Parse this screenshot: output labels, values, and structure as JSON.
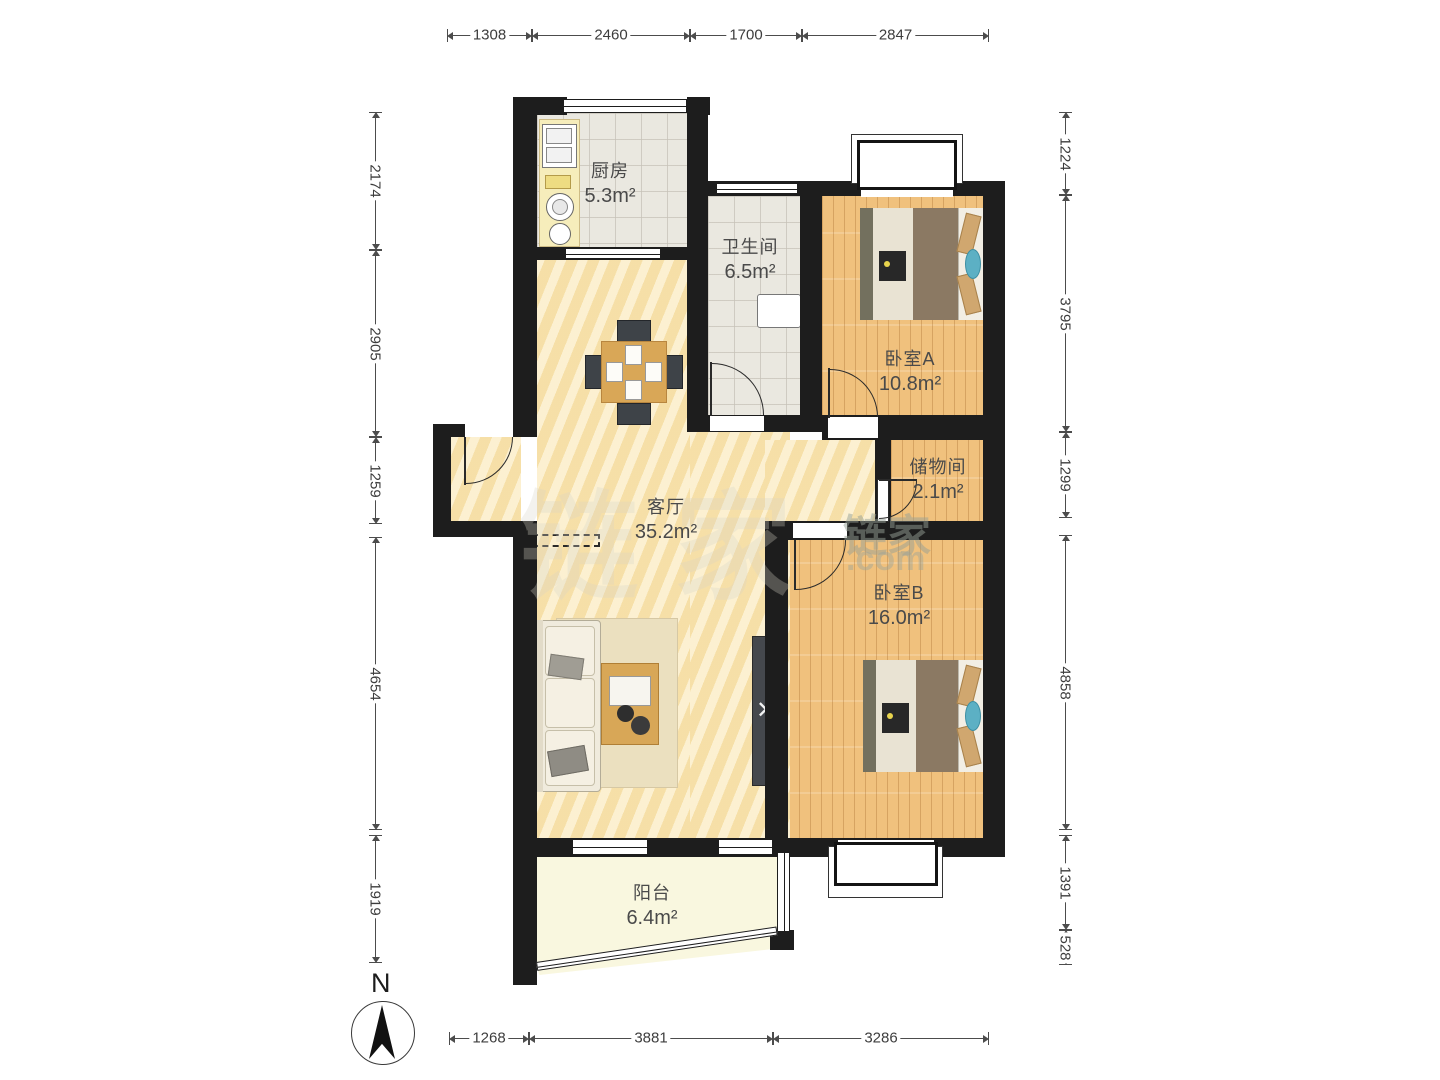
{
  "meta": {
    "type": "residential-floor-plan",
    "orientation_label": "N"
  },
  "north_indicator": {
    "label": "N"
  },
  "watermark": {
    "brand_cn": "链家",
    "brand_suffix": ".com",
    "ghost_text": "链家"
  },
  "rooms": [
    {
      "id": "kitchen",
      "name": "厨房",
      "area": "5.3m²"
    },
    {
      "id": "bathroom",
      "name": "卫生间",
      "area": "6.5m²"
    },
    {
      "id": "bedroom_a",
      "name": "卧室A",
      "area": "10.8m²"
    },
    {
      "id": "storage",
      "name": "储物间",
      "area": "2.1m²"
    },
    {
      "id": "living",
      "name": "客厅",
      "area": "35.2m²"
    },
    {
      "id": "bedroom_b",
      "name": "卧室B",
      "area": "16.0m²"
    },
    {
      "id": "balcony",
      "name": "阳台",
      "area": "6.4m²"
    }
  ],
  "dimensions_mm": {
    "top": [
      1308,
      2460,
      1700,
      2847
    ],
    "bottom": [
      1268,
      3881,
      3286
    ],
    "left": [
      2174,
      2905,
      1259,
      4654,
      1919
    ],
    "right": [
      1224,
      3795,
      1299,
      4858,
      1391,
      528
    ]
  },
  "dimension_segments": [
    {
      "v": "1308",
      "o": "h",
      "x": 447,
      "y": 35,
      "l": 85
    },
    {
      "v": "2460",
      "o": "h",
      "x": 532,
      "y": 35,
      "l": 158
    },
    {
      "v": "1700",
      "o": "h",
      "x": 690,
      "y": 35,
      "l": 112
    },
    {
      "v": "2847",
      "o": "h",
      "x": 802,
      "y": 35,
      "l": 187
    },
    {
      "v": "1268",
      "o": "h",
      "x": 449,
      "y": 1038,
      "l": 80
    },
    {
      "v": "3881",
      "o": "h",
      "x": 529,
      "y": 1038,
      "l": 244
    },
    {
      "v": "3286",
      "o": "h",
      "x": 773,
      "y": 1038,
      "l": 216
    },
    {
      "v": "2174",
      "o": "v",
      "x": 375,
      "y": 112,
      "l": 138
    },
    {
      "v": "2905",
      "o": "v",
      "x": 375,
      "y": 250,
      "l": 187
    },
    {
      "v": "1259",
      "o": "v",
      "x": 375,
      "y": 437,
      "l": 87
    },
    {
      "v": "4654",
      "o": "v",
      "x": 375,
      "y": 537,
      "l": 293
    },
    {
      "v": "1919",
      "o": "v",
      "x": 375,
      "y": 835,
      "l": 128
    },
    {
      "v": "1224",
      "o": "v",
      "x": 1065,
      "y": 112,
      "l": 83
    },
    {
      "v": "3795",
      "o": "v",
      "x": 1065,
      "y": 195,
      "l": 237
    },
    {
      "v": "1299",
      "o": "v",
      "x": 1065,
      "y": 432,
      "l": 86
    },
    {
      "v": "4858",
      "o": "v",
      "x": 1065,
      "y": 535,
      "l": 295
    },
    {
      "v": "1391",
      "o": "v",
      "x": 1065,
      "y": 835,
      "l": 95
    },
    {
      "v": "528",
      "o": "v",
      "x": 1065,
      "y": 930,
      "l": 35
    }
  ],
  "colors": {
    "wall": "#1d1d1d",
    "living_floor": "#f8e5b2",
    "wood_floor": "#f0c17d",
    "tile_floor": "#eae8e0",
    "balcony_floor": "#f9f7df",
    "dimension_line": "#4c4c4c",
    "label_text": "#4a4a4a",
    "bed_blanket": "#8b7963",
    "teal_pillow": "#5cb0c4"
  }
}
